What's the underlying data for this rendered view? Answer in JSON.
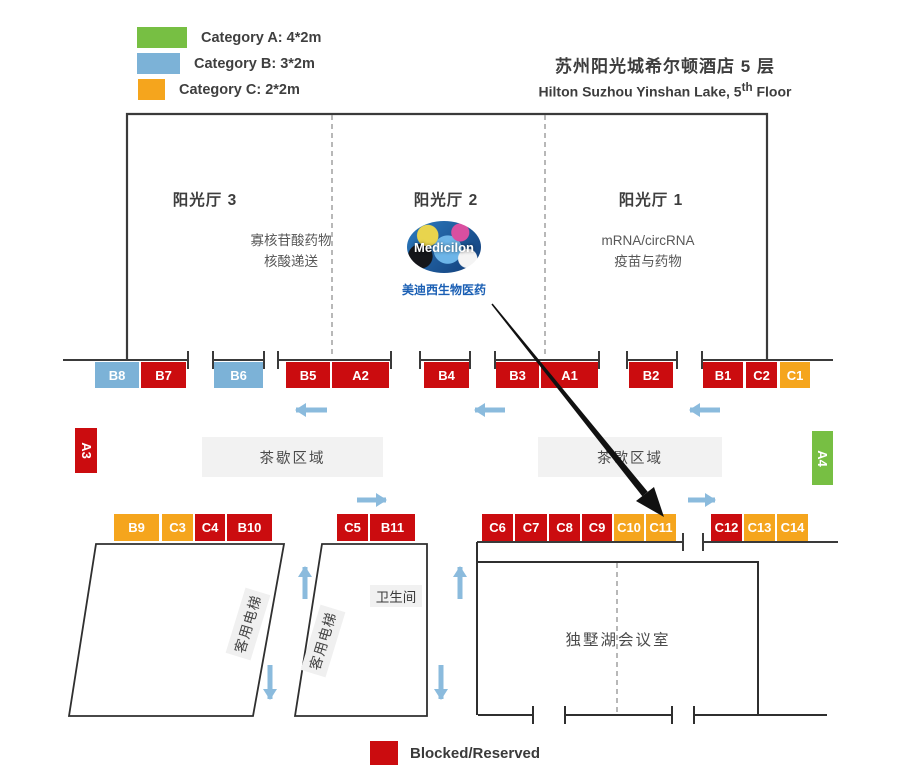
{
  "title": {
    "zh": "苏州阳光城希尔顿酒店 5 层",
    "en_prefix": "Hilton Suzhou Yinshan Lake, 5",
    "en_sup": "th",
    "en_suffix": " Floor"
  },
  "legend": {
    "items": [
      {
        "label": "Category A: 4*2m",
        "color": "#77bf43"
      },
      {
        "label": "Category B: 3*2m",
        "color": "#7cb2d7"
      },
      {
        "label": "Category C: 2*2m",
        "color": "#f5a51d"
      }
    ],
    "blocked_label": "Blocked/Reserved",
    "blocked_color": "#cb0c0f"
  },
  "halls": {
    "hall3": "阳光厅 3",
    "hall2": "阳光厅 2",
    "hall1": "阳光厅 1"
  },
  "topics": {
    "hall3_line1": "寡核苷酸药物",
    "hall3_line2": "核酸递送",
    "hall1_line1": "mRNA/circRNA",
    "hall1_line2": "疫苗与药物"
  },
  "logo": {
    "text": "Medicilon",
    "caption": "美迪西生物医药"
  },
  "areas": {
    "tea": "茶歇区域",
    "elevator": "客用电梯",
    "restroom": "卫生间",
    "meeting_room": "独墅湖会议室"
  },
  "colors": {
    "red_blocked": "#cb0c0f",
    "blue_category_b": "#7cb2d7",
    "orange_category_c": "#f5a51d",
    "green_category_a": "#77bf43",
    "flow_arrow_blue": "#8bbbdd"
  },
  "booths_top": [
    {
      "id": "B8",
      "category": "B",
      "color": "blue"
    },
    {
      "id": "B7",
      "category": "B",
      "color": "red"
    },
    {
      "id": "B6",
      "category": "B",
      "color": "blue"
    },
    {
      "id": "B5",
      "category": "B",
      "color": "red"
    },
    {
      "id": "A2",
      "category": "A",
      "color": "red"
    },
    {
      "id": "B4",
      "category": "B",
      "color": "red"
    },
    {
      "id": "B3",
      "category": "B",
      "color": "red"
    },
    {
      "id": "A1",
      "category": "A",
      "color": "red"
    },
    {
      "id": "B2",
      "category": "B",
      "color": "red"
    },
    {
      "id": "B1",
      "category": "B",
      "color": "red"
    },
    {
      "id": "C2",
      "category": "C",
      "color": "red"
    },
    {
      "id": "C1",
      "category": "C",
      "color": "orange"
    }
  ],
  "booths_side": [
    {
      "id": "A3",
      "category": "A",
      "color": "red"
    },
    {
      "id": "A4",
      "category": "A",
      "color": "green"
    }
  ],
  "booths_bottom": [
    {
      "id": "B9",
      "category": "B",
      "color": "orange"
    },
    {
      "id": "C3",
      "category": "C",
      "color": "orange"
    },
    {
      "id": "C4",
      "category": "C",
      "color": "red"
    },
    {
      "id": "B10",
      "category": "B",
      "color": "red"
    },
    {
      "id": "C5",
      "category": "C",
      "color": "red"
    },
    {
      "id": "B11",
      "category": "B",
      "color": "red"
    },
    {
      "id": "C6",
      "category": "C",
      "color": "red"
    },
    {
      "id": "C7",
      "category": "C",
      "color": "red"
    },
    {
      "id": "C8",
      "category": "C",
      "color": "red"
    },
    {
      "id": "C9",
      "category": "C",
      "color": "red"
    },
    {
      "id": "C10",
      "category": "C",
      "color": "orange"
    },
    {
      "id": "C11",
      "category": "C",
      "color": "orange"
    },
    {
      "id": "C12",
      "category": "C",
      "color": "red"
    },
    {
      "id": "C13",
      "category": "C",
      "color": "orange"
    },
    {
      "id": "C14",
      "category": "C",
      "color": "orange"
    }
  ]
}
